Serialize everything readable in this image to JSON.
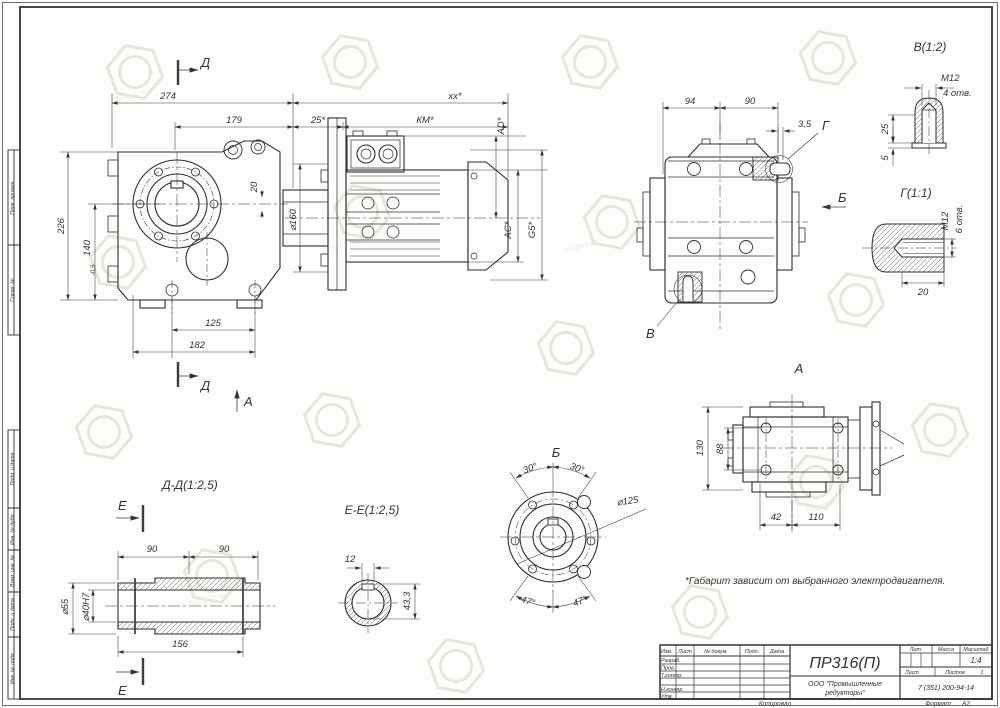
{
  "frame": {
    "stamps": [
      "Перв. примен.",
      "Справ. №",
      "Подп. и дата",
      "Инв. № дубл.",
      "Взам. инв. №",
      "Подп. и дата",
      "Инв. № подл."
    ]
  },
  "front": {
    "d_top": "Д",
    "d_bot": "Д",
    "a_arrow": "А",
    "w274": "274",
    "xx": "xx*",
    "w179": "179",
    "w25": "25*",
    "km": "КМ*",
    "h226": "226",
    "h140": "140",
    "h140tol": "-0,5",
    "v20": "20",
    "d160": "⌀160",
    "ad": "AD*",
    "ac": "AC*",
    "g5": "G5*",
    "w125": "125",
    "w182": "182"
  },
  "side": {
    "w94": "94",
    "w90": "90",
    "t35": "3,5",
    "g": "Г",
    "b": "Б",
    "v": "В"
  },
  "detail_v": {
    "title": "В(1:2)",
    "m12": "M12",
    "holes": "4 отв.",
    "h25": "25",
    "h5": "5"
  },
  "detail_g": {
    "title": "Г(1:1)",
    "m12": "M12",
    "holes": "6 отв.",
    "w20": "20"
  },
  "view_a": {
    "title": "А",
    "h130": "130",
    "h88": "88",
    "w42": "42",
    "w110": "110"
  },
  "dd": {
    "title": "Д-Д(1:2,5)",
    "e_top": "Е",
    "e_bot": "Е",
    "w90a": "90",
    "w90b": "90",
    "d55": "⌀55",
    "d40": "⌀40H7",
    "w156": "156"
  },
  "ee": {
    "title": "Е-Е(1:2,5)",
    "w12": "12",
    "h433": "43,3"
  },
  "vb": {
    "title": "Б",
    "a30l": "30°",
    "a30r": "30°",
    "a47l": "47°",
    "a47r": "47°",
    "d125": "⌀125"
  },
  "note": "*Габарит зависит от выбранного электродвигателя.",
  "tb": {
    "name": "ПР316(П)",
    "org1": "ООО \"Промышленные",
    "org2": "редукторы\"",
    "phone": "7 (351) 200-94-14",
    "izm": "Изм.",
    "list": "Лист",
    "ndoc": "№ докум.",
    "podp": "Подп.",
    "data": "Дата",
    "rows": [
      "Разраб.",
      "Пров.",
      "Т.контр.",
      "Н.контр.",
      "Утв."
    ],
    "lit": "Лит.",
    "massa": "Масса",
    "masshtab": "Масштаб",
    "scale": "1:4",
    "list2": "Лист",
    "listov": "Листов",
    "listov_val": "1",
    "kopiroval": "Копировал",
    "format": "Формат",
    "format_val": "А2"
  },
  "wm": {
    "text": "РЕДУКТОРЫ"
  }
}
